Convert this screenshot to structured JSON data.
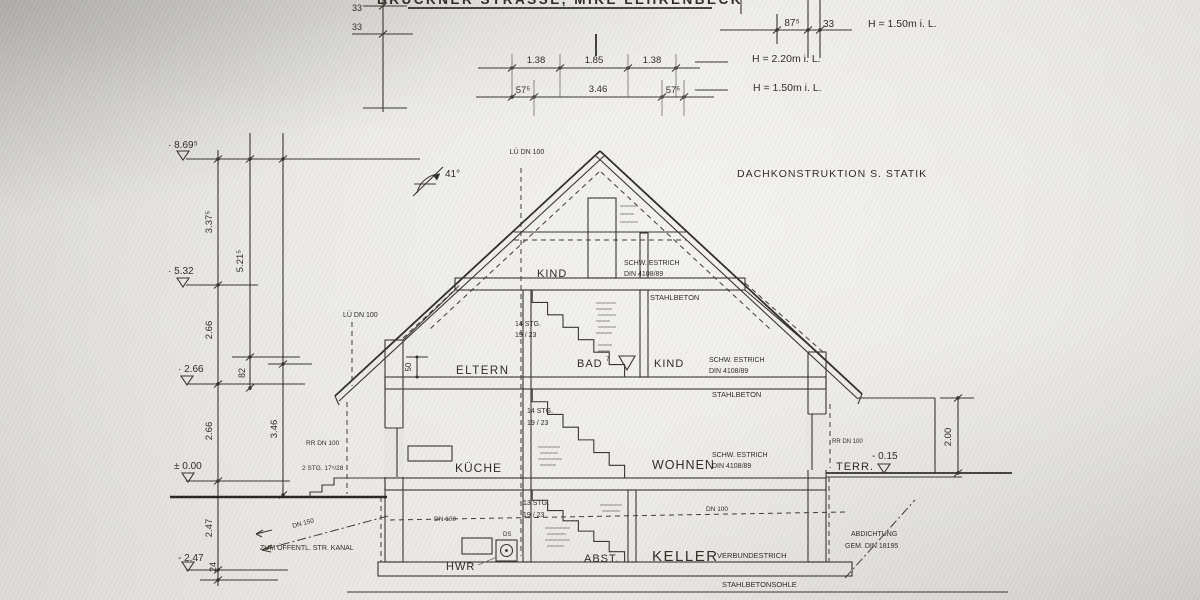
{
  "title": "BRÜCKNER STRASSE, MIKE LEHRENBECK",
  "top": {
    "tl33a": "33",
    "tl33b": "33",
    "c1a": "1.38",
    "c1b": "1.85",
    "c1c": "1.38",
    "c2a": "57⁵",
    "c2b": "3.46",
    "c2c": "57⁵",
    "c3a": "87⁵",
    "c3b": "33",
    "h_right": "H = 1.50m   i. L.",
    "h_mid": "H = 2.20m i. L.",
    "h_low": "H = 1.50m  i. L."
  },
  "levels": {
    "p869": "· 8.69⁵",
    "p532": "· 5.32",
    "p266": "· 2.66",
    "p000": "± 0.00",
    "m247": "- 2.47",
    "m015": "- 0.15"
  },
  "dims": {
    "d337": "3.37⁵",
    "d521": "5.21⁵",
    "d266a": "2.66",
    "d82": "82",
    "d266b": "2.66",
    "d346": "3.46",
    "d247": "2.47",
    "d24": "24",
    "d50": "50",
    "d200": "2.00"
  },
  "roof": {
    "angle": "41°",
    "note": "DACHKONSTRUKTION  S. STATIK",
    "vent_ridge": "LÜ  DN 100",
    "vent_left": "LÜ  DN 100"
  },
  "dg": {
    "room": "KIND",
    "estrich1": "SCHW. ESTRICH",
    "estrich2": "DIN 4108/89",
    "slab": "STAHLBETON",
    "stairs1": "14 STG.",
    "stairs2": "19 / 23"
  },
  "og": {
    "room1": "ELTERN",
    "room2": "BAD",
    "room2_sup": "7",
    "room3": "KIND",
    "estrich1": "SCHW. ESTRICH",
    "estrich2": "DIN 4108/89",
    "slab": "STAHLBETON",
    "stairs1": "14 STG.",
    "stairs2": "19 / 23"
  },
  "eg": {
    "room1": "KÜCHE",
    "room2": "WOHNEN",
    "estrich1": "SCHW. ESTRICH",
    "estrich2": "DIN 4108/89",
    "terrace": "TERR.",
    "rr_left": "RR DN 100",
    "rr_right": "RR DN 100",
    "ext_stairs": "2 STG. 17⁵/28"
  },
  "kg": {
    "room1": "HWR",
    "ds": "DS",
    "room2": "ABST.",
    "room3": "KELLER",
    "screed": "VERBUNDESTRICH",
    "sole": "STAHLBETONSOHLE",
    "stairs1": "13 STG.",
    "stairs2": "19 / 23",
    "dn100a": "DN 100",
    "dn100b": "DN 100",
    "dn150": "DN 150",
    "sewer_note": "ZUM ÖFFENTL.  STR.  KANAL",
    "seal1": "ABDICHTUNG",
    "seal2": "GEM.  DIN  18195"
  }
}
